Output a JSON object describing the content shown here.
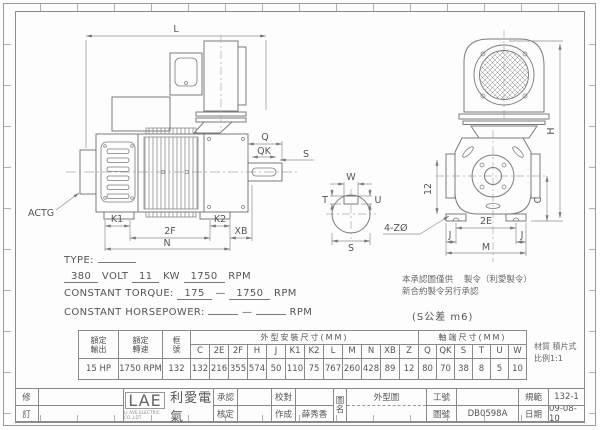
{
  "drawing": {
    "views": {
      "side_view": "motor-side-view",
      "front_view": "motor-front-view",
      "shaft_section": "shaft-cross-section"
    },
    "labels": {
      "actg": "ACTG",
      "L": "L",
      "K1": "K1",
      "F2": "2F",
      "K2": "K2",
      "XB": "XB",
      "N": "N",
      "Q": "Q",
      "QK": "QK",
      "S_side": "S",
      "W": "W",
      "T": "T",
      "U": "U",
      "S": "S",
      "H": "H",
      "C": "C",
      "Z12": "12",
      "E2": "2E",
      "J_left": "J",
      "J_right": "J",
      "M": "M",
      "holes": "4-ZØ"
    },
    "notes": {
      "approval_1": "本承認圖僅供",
      "approval_2": "製令（利愛製令）",
      "approval_3": "新合約製令另行承認",
      "tolerance": "(S公差 m6)"
    }
  },
  "spec": {
    "type_label": "TYPE:",
    "volt_value": "380",
    "volt_unit": "VOLT",
    "kw_value": "11",
    "kw_unit": "KW",
    "rpm_value": "1750",
    "rpm_unit": "RPM",
    "torque_label": "CONSTANT TORQUE:",
    "torque_from": "175",
    "dash": "—",
    "torque_to": "1750",
    "torque_unit": "RPM",
    "hp_label": "CONSTANT HORSEPOWER:",
    "hp_unit": "RPM"
  },
  "table": {
    "rated_output_l1": "額定",
    "rated_output_l2": "輸出",
    "rated_speed_l1": "額定",
    "rated_speed_l2": "轉速",
    "frame_l1": "框",
    "frame_l2": "號",
    "group_mount": "外型安裝尺寸(MM)",
    "group_shaft": "軸端尺寸(MM)",
    "mount_cols": [
      "C",
      "2E",
      "2F",
      "H",
      "J",
      "K1",
      "K2",
      "L",
      "M",
      "N",
      "XB",
      "Z"
    ],
    "shaft_cols": [
      "Q",
      "QK",
      "S",
      "T",
      "U",
      "W"
    ],
    "output_value": "15 HP",
    "speed_value": "1750 RPM",
    "frame_value": "132",
    "mount_vals": [
      "132",
      "216",
      "355",
      "574",
      "50",
      "110",
      "75",
      "767",
      "260",
      "428",
      "89",
      "12"
    ],
    "shaft_vals": [
      "80",
      "70",
      "38",
      "8",
      "5",
      "10"
    ],
    "material": "材質 積片式",
    "scale": "比例1:1"
  },
  "titleblock": {
    "rev_top": "修",
    "rev_bottom": "訂",
    "logo_text": "LAE",
    "logo_sub": "LI AVE ELECTRIC CO.,LDT",
    "logo_cn": "利愛電氣",
    "approve_label": "承認",
    "check_label": "核定",
    "proof_label": "校對",
    "made_label": "作成",
    "made_value": "薛秀香",
    "name_label_1": "圖",
    "name_label_2": "名",
    "drawing_name": "外型圖",
    "work_no_label": "工號",
    "work_no_value": "",
    "drawing_no_label": "圖號",
    "drawing_no_value": "DB0598A",
    "spec_label": "規範",
    "spec_value": "132-1",
    "date_label": "日期",
    "date_value": "09-08-10"
  }
}
